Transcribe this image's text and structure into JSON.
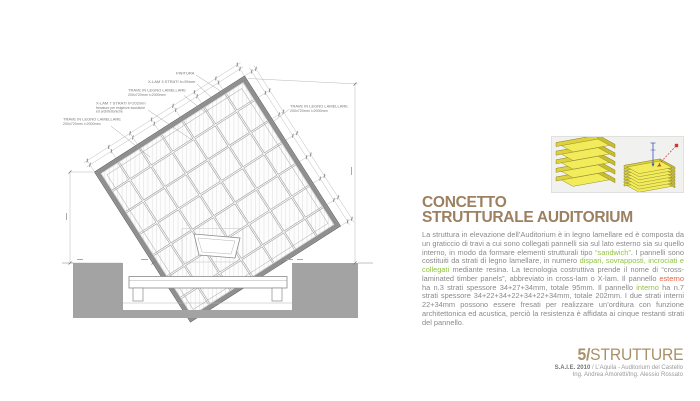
{
  "colors": {
    "green": "#8fc43f",
    "orange": "#e4684a",
    "title_tan": "#9c8061",
    "footer_tan": "#aa9068",
    "body_gray": "#8a8a8a",
    "drawing_gray": "#8f8f8f",
    "foundation_gray": "#a3a3a3",
    "panel_yellow": "#f3ec5a"
  },
  "drawing": {
    "labels": {
      "finitura": "FINITURA",
      "xlam3": "X-LAM 3 STRATI h=95mm",
      "xlam7_1": "X-LAM 7 STRATI h=202mm",
      "xlam7_2": "fresature per esigenze acustiche",
      "xlam7_3": "ed architettoniche",
      "trave_line1": "TRAVE IN LEGNO LAMELLARE",
      "trave_line2": "200x720mm i=2000mm"
    }
  },
  "section": {
    "title_line1": "CONCETTO",
    "title_line2": "STRUTTURALE AUDITORIUM",
    "body_segments": [
      {
        "t": "La struttura in elevazione dell’Auditorium è in legno lamellare ed è composta da un graticcio di travi a cui sono collegati pannelli sia sul lato esterno sia su quello interno, in modo da formare elementi strutturali tipo "
      },
      {
        "t": "“sandwich”",
        "c": "green"
      },
      {
        "t": ". I pannelli sono costituiti da strati di legno lamellare, in numero "
      },
      {
        "t": "dispari, sovrapposti, incrociati e collegati",
        "c": "green"
      },
      {
        "t": " mediante resina. La tecnologia costruttiva prende il nome di “cross-laminated timber panels”, abbreviato in cross-lam o X-lam. Il pannello "
      },
      {
        "t": "esterno",
        "c": "orange"
      },
      {
        "t": " ha n.3 strati spessore 34+27+34mm, totale 95mm. Il pannello "
      },
      {
        "t": "interno",
        "c": "green"
      },
      {
        "t": " ha n.7 strati spessore 34+22+34+22+34+22+34mm, totale 202mm. I due strati interni 22+34mm possono essere fresati per realizzare un’orditura con funzione architettonica ed acustica, perciò la resistenza è affidata ai cinque restanti strati del pannello."
      }
    ]
  },
  "footer": {
    "number": "5/",
    "label": "STRUTTURE",
    "credit1_bold": "S.A.I.E. 2010",
    "credit1_rest": " / L’Aquila - Auditorium del Castello",
    "credit2": "Ing. Andrea Amoretti/Ing. Alessio Rossato"
  }
}
